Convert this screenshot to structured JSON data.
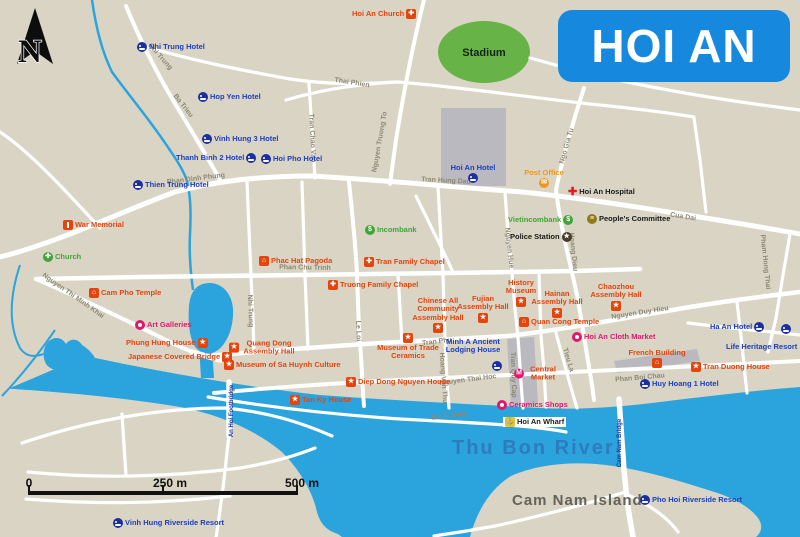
{
  "title": "HOI AN",
  "compass": "N",
  "colors": {
    "water": "#2ba4dd",
    "land": "#d9d4c4",
    "road": "#ffffff",
    "title_bg": "#1688dd",
    "hotel_blue": "#1c3ec0",
    "sight_red": "#e5440d",
    "pink": "#e0186c",
    "green": "#3fa535",
    "orange": "#f7941d",
    "gray_block": "#b9b9bf",
    "stadium_green": "#68b348"
  },
  "icons": {
    "star": "★",
    "cross": "✚",
    "temple": "⌂",
    "dollar": "$",
    "envelope": "✉",
    "anchor": "⚓",
    "building": "≡",
    "m": "M",
    "police": "★"
  },
  "scale_bar": {
    "start": "0",
    "middle": "250 m",
    "end": "500 m"
  },
  "areas": {
    "stadium": "Stadium",
    "thu_bon_river": "Thu Bon River",
    "cam_nam_island": "Cam Nam Island",
    "an_hoi_footbridge": "An Hoi Footbridge",
    "cam_nam_bridge": "Cam Nam Bridge"
  },
  "pois": {
    "hoi_an_church": "Hoi An Church",
    "nhi_trung_hotel": "Nhi Trung Hotel",
    "hop_yen_hotel": "Hop Yen Hotel",
    "vinh_hung_3_hotel": "Vinh Hung 3 Hotel",
    "thanh_binh_2_hotel": "Thanh Binh 2 Hotel",
    "hoi_pho_hotel": "Hoi Pho Hotel",
    "thien_trung_hotel": "Thien Trung Hotel",
    "hoi_an_hotel": "Hoi An Hotel",
    "war_memorial": "War Memorial",
    "church": "Church",
    "incombank": "Incombank",
    "vietincombank": "Vietincombank",
    "police_station": "Police Station",
    "post_office": "Post Office",
    "hoi_an_hospital": "Hoi An Hospital",
    "peoples_committee": "People's Committee",
    "phac_hat_pagoda": "Phac Hat Pagoda",
    "tran_family_chapel": "Tran Family Chapel",
    "truong_family_chapel": "Truong Family Chapel",
    "cam_pho_temple": "Cam Pho Temple",
    "art_galleries": "Art Galleries",
    "phung_hung_house": "Phung Hung House",
    "japanese_covered_bridge": "Japanese Covered Bridge",
    "quang_dong_assembly_hall": "Quang Dong Assembly Hall",
    "museum_sa_huynh": "Museum of Sa Huynh Culture",
    "museum_trade_ceramics": "Museum of Trade Ceramics",
    "diep_dong_nguyen_house": "Diep Dong Nguyen House",
    "tan_ky_house": "Tan Ky House",
    "chinese_all_community": "Chinese All Community Assembly Hall",
    "fujian_assembly_hall": "Fujian Assembly Hall",
    "hainan_assembly_hall": "Hainan Assembly Hall",
    "history_museum": "History Museum",
    "quan_cong_temple": "Quan Cong Temple",
    "chaozhou_assembly_hall": "Chaozhou Assembly Hall",
    "hoi_an_cloth_market": "Hoi An Cloth Market",
    "minh_a": "Minh A Ancient Lodging House",
    "central_market": "Central Market",
    "ceramics_shops": "Ceramics Shops",
    "hoi_an_wharf": "Hoi An Wharf",
    "french_building": "French Building",
    "tran_duong_house": "Tran Duong House",
    "ha_an_hotel": "Ha An Hotel",
    "life_heritage_resort": "Life Heritage Resort",
    "huy_hoang_1_hotel": "Huy Hoang 1 Hotel",
    "vinh_hung_riverside_resort": "Vinh Hung Riverside Resort",
    "pho_hoi_riverside_resort": "Pho Hoi Riverside Resort"
  },
  "roads": {
    "nhi_trung": "Nhi Trung",
    "ba_trieu": "Ba Trieu",
    "tran_chao_van": "Tran Chao Van",
    "thai_phien": "Thai Phien",
    "nguyen_truong_to": "Nguyen Truong To",
    "phan_dinh_phung": "Phan Dinh Phung",
    "tran_hung_dao": "Tran Hung Dao",
    "ngo_gia_tu": "Ngo Gia Tu",
    "cua_dai": "Cua Dai",
    "pham_hong_thai": "Pham Hong Thai",
    "hoang_dieu": "Hoang Dieu",
    "nguyen_hue": "Nguyen Hue",
    "phan_chu_trinh": "Phan Chu Trinh",
    "nguyen_thi_minh_khai": "Nguyen Thi Minh Khai",
    "le_loi": "Le Loi",
    "tran_phu": "Tran Phu",
    "nguyen_duy_hieu": "Nguyen Duy Hieu",
    "hoang_van_thu": "Hoang Van Thu",
    "nguyen_thai_hoc": "Nguyen Thai Hoc",
    "tran_quy_cap": "Tran Quy Cap",
    "tieu_la": "Tieu La",
    "bach_dang": "Bach Dang",
    "phan_boi_chau": "Phan Boi Chau"
  }
}
